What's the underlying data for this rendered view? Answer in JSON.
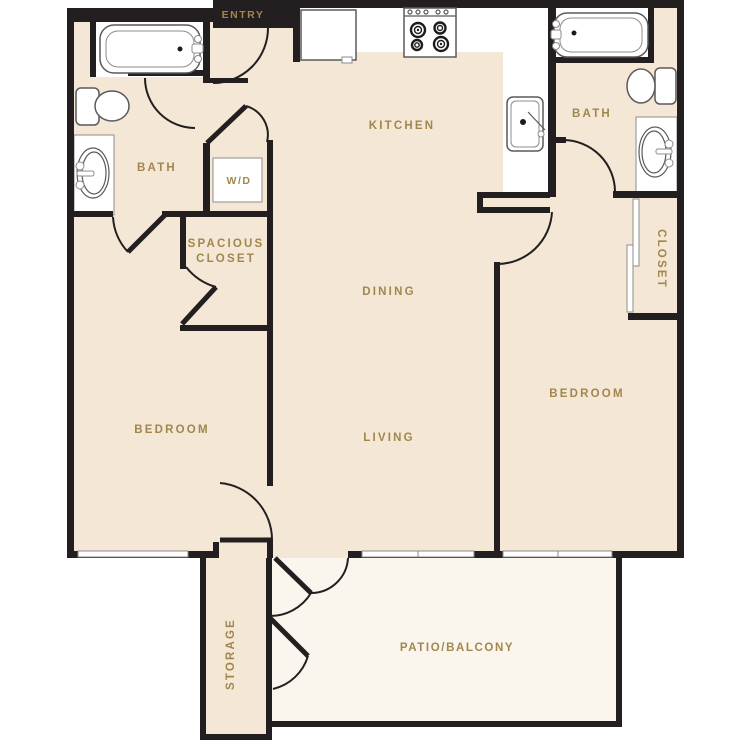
{
  "floorplan": {
    "title": "Two bedroom two bath apartment floor plan with patio",
    "colors": {
      "wall": "#231f20",
      "floor": "#f4e7d5",
      "patio": "#faf6ee",
      "gold": "#a1874d"
    },
    "labels": {
      "entry": "ENTRY",
      "kitchen": "KITCHEN",
      "bath_left": "BATH",
      "bath_right": "BATH",
      "wd": "W/D",
      "spacious_closet_line1": "SPACIOUS",
      "spacious_closet_line2": "CLOSET",
      "dining": "DINING",
      "living": "LIVING",
      "bedroom_left": "BEDROOM",
      "bedroom_right": "BEDROOM",
      "closet_right": "CLOSET",
      "storage": "STORAGE",
      "patio": "PATIO/BALCONY"
    }
  }
}
